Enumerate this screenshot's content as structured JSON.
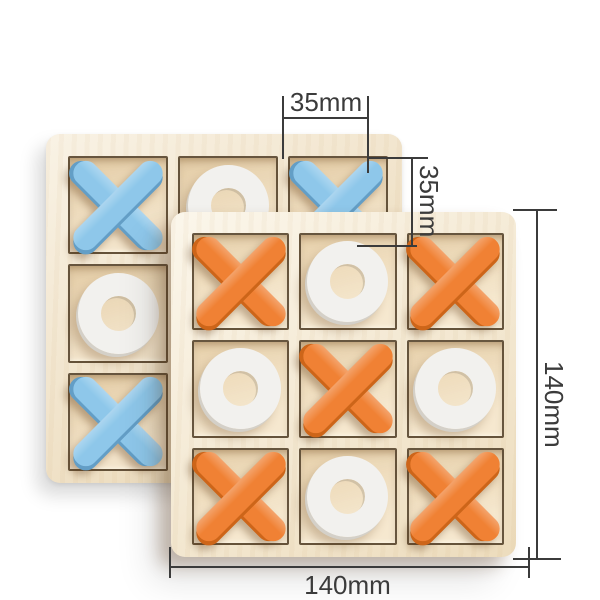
{
  "page": {
    "background": "#ffffff"
  },
  "annotations": {
    "line_color": "#3b3b3b",
    "text_color": "#3b3b3b",
    "cell_width": {
      "label": "35mm"
    },
    "cell_height": {
      "label": "35mm"
    },
    "board_height": {
      "label": "140mm"
    },
    "board_width": {
      "label": "140mm"
    }
  },
  "boards": {
    "back": {
      "wood": "#f2e3c5",
      "cell_wood": "#eedab6",
      "x_color": "#8ec7ea",
      "x_shade": "#639ec6",
      "o_color": "#f2f1ee",
      "o_shade": "#d4d0c8",
      "grid": [
        [
          "X",
          "O",
          "X"
        ],
        [
          "O",
          null,
          null
        ],
        [
          "X",
          null,
          null
        ]
      ]
    },
    "front": {
      "wood": "#f7ecd3",
      "cell_wood": "#f2dfbc",
      "x_color": "#f08134",
      "x_shade": "#cd6519",
      "o_color": "#f2f1ee",
      "o_shade": "#d4d0c8",
      "grid": [
        [
          "X",
          "O",
          "X"
        ],
        [
          "O",
          "X",
          "O"
        ],
        [
          "X",
          "O",
          "X"
        ]
      ]
    }
  }
}
